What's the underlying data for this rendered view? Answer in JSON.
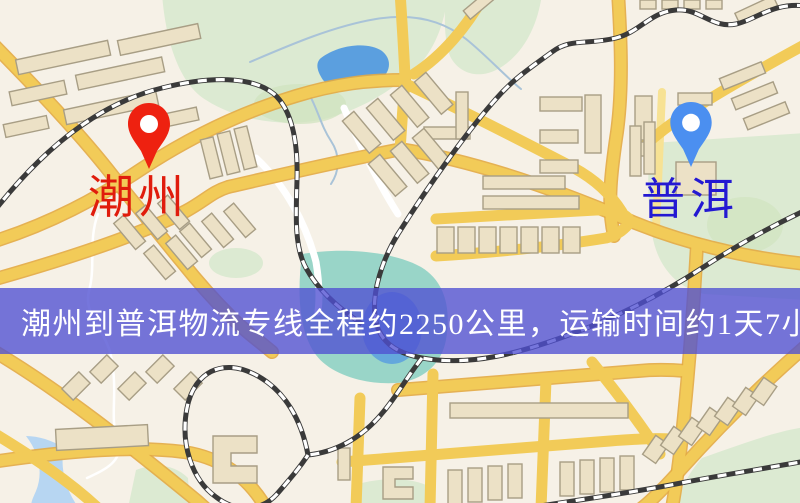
{
  "banner": {
    "text": "潮州到普洱物流专线全程约2250公里，运输时间约1天7小时."
  },
  "route": {
    "origin": "潮州",
    "destination": "普洱",
    "distance_text": "约2250公里",
    "duration_text": "约1天7小时"
  },
  "markers": {
    "origin": {
      "label": "潮州",
      "pin_color_name": "red"
    },
    "destination": {
      "label": "普洱",
      "pin_color_name": "blue"
    }
  },
  "palette": {
    "map-bg": "#f6f1e7",
    "park-green": "#dcead2",
    "park-dark": "#cfe3bd",
    "water-blue": "#5b9fdf",
    "water-teal": "#8fd2c4",
    "water-light": "#b7d6f2",
    "creek": "#a9c3d8",
    "road-yellow": "#f2cb58",
    "road-casing": "#e3aa42",
    "road-pale": "#f7e294",
    "rail-dark": "#3a3a3a",
    "building-fill": "#ece1c6",
    "building-stroke": "#a89e85",
    "pin-red": "#ee2110",
    "pin-blue": "#4b8ff0",
    "label-red": "#e01c0c",
    "label-blue": "#2419d2",
    "banner-bg": "rgba(80,80,210,0.78)",
    "banner-text": "#ffffff"
  }
}
